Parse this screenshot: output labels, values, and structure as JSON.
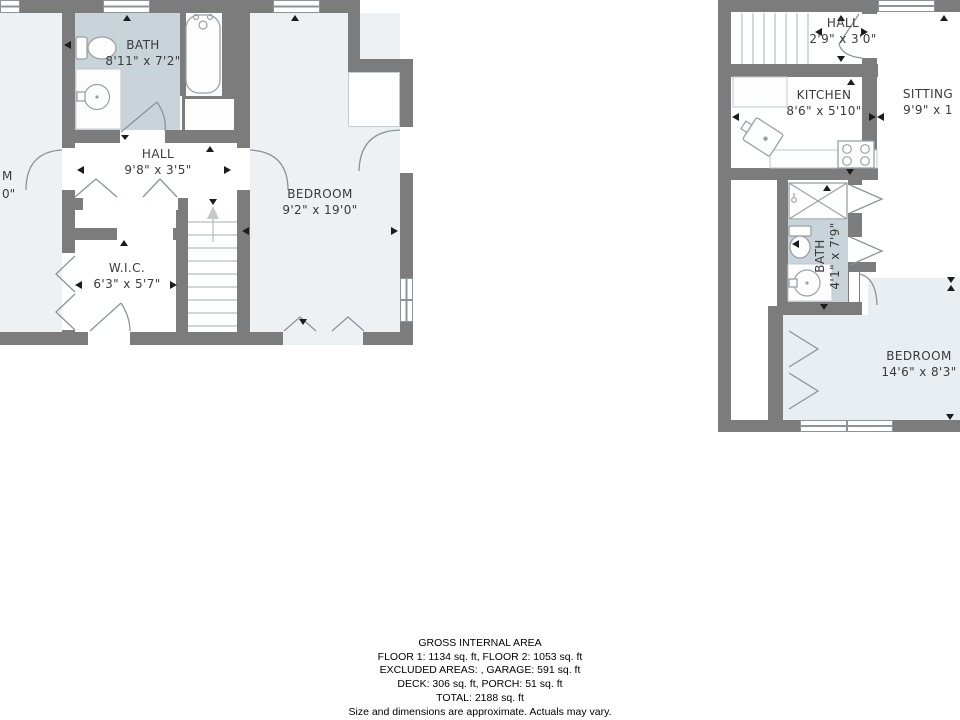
{
  "colors": {
    "wall": "#7c7c7c",
    "bath_fill": "#c9d3da",
    "room_fill": "#edf1f4",
    "room_fill_alt": "#e9eef2",
    "line": "#8d9499",
    "fixture_line": "#9aa1a7",
    "stair_line": "#b8bdc1",
    "marker": "#1c1c1c",
    "text": "#3a3a3a"
  },
  "left_plan": {
    "rooms": [
      {
        "name": "BATH",
        "dims": "8'11\" x 7'2\""
      },
      {
        "name": "HALL",
        "dims": "9'8\" x 3'5\""
      },
      {
        "name": "BEDROOM",
        "dims": "9'2\" x 19'0\""
      },
      {
        "name": "W.I.C.",
        "dims": "6'3\" x 5'7\""
      }
    ],
    "partial_room_label": {
      "line1": "M",
      "line2": "0\""
    }
  },
  "right_plan": {
    "rooms": [
      {
        "name": "HALL",
        "dims": "2'9\" x 3'0\""
      },
      {
        "name": "KITCHEN",
        "dims": "8'6\" x 5'10\""
      },
      {
        "name": "SITTING",
        "dims": "9'9\" x 1"
      },
      {
        "name": "BATH",
        "dims": "4'1\" x 7'9\""
      },
      {
        "name": "BEDROOM",
        "dims": "14'6\" x 8'3\""
      }
    ]
  },
  "summary": {
    "title": "GROSS INTERNAL AREA",
    "floors": "FLOOR 1: 1134 sq. ft, FLOOR 2: 1053 sq. ft",
    "excluded": "EXCLUDED AREAS: , GARAGE: 591 sq. ft",
    "deck_porch": "DECK: 306 sq. ft, PORCH: 51 sq. ft",
    "total": "TOTAL: 2188 sq. ft",
    "disclaimer": "Size and dimensions are approximate. Actuals may vary."
  }
}
